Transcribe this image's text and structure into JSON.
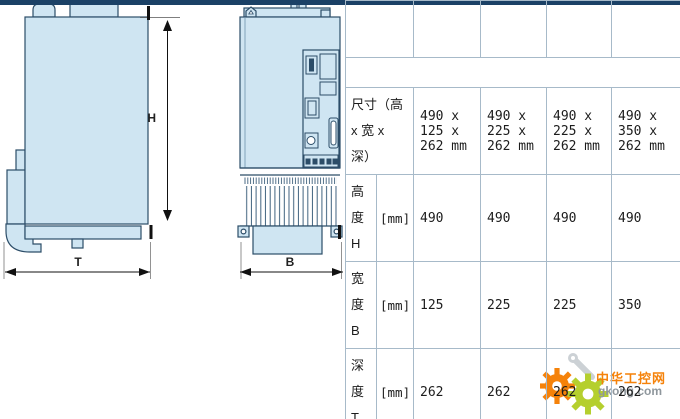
{
  "drawings": {
    "side_view": {
      "height_dim_label": "H",
      "depth_dim_label": "T"
    },
    "front_view": {
      "width_dim_label": "B"
    }
  },
  "table": {
    "column_headers": [
      "HCS03.1E\n-W0070",
      "HCS03.1E\n-W0100",
      "HCS03.1E\n-W0150",
      "HCS03.1E\n-W0210"
    ],
    "section_header": "规格",
    "rows": [
      {
        "label": "尺寸（高\nx 宽 x\n深）",
        "unit": "",
        "values": [
          "490 x\n125 x\n262 mm",
          "490 x\n225 x\n262 mm",
          "490 x\n225 x\n262 mm",
          "490 x\n350 x\n262 mm"
        ]
      },
      {
        "label": "高\n度\nH",
        "unit": "[mm]",
        "values": [
          "490",
          "490",
          "490",
          "490"
        ]
      },
      {
        "label": "宽\n度\nB",
        "unit": "[mm]",
        "values": [
          "125",
          "225",
          "225",
          "350"
        ]
      },
      {
        "label": "深\n度\nT",
        "unit": "[mm]",
        "values": [
          "262",
          "262",
          "262",
          "262"
        ]
      }
    ]
  },
  "watermark": {
    "site_name": "中华工控网",
    "site_url": "gkong.com"
  },
  "colors": {
    "header_navy": "#1b4166",
    "section_blue": "#7f96ac",
    "grid_line": "#a7bac9",
    "drawing_fill": "#cfe5f2",
    "drawing_stroke": "#2c4d68",
    "watermark_orange": "#f5820a",
    "watermark_green": "#b5cf2e"
  }
}
